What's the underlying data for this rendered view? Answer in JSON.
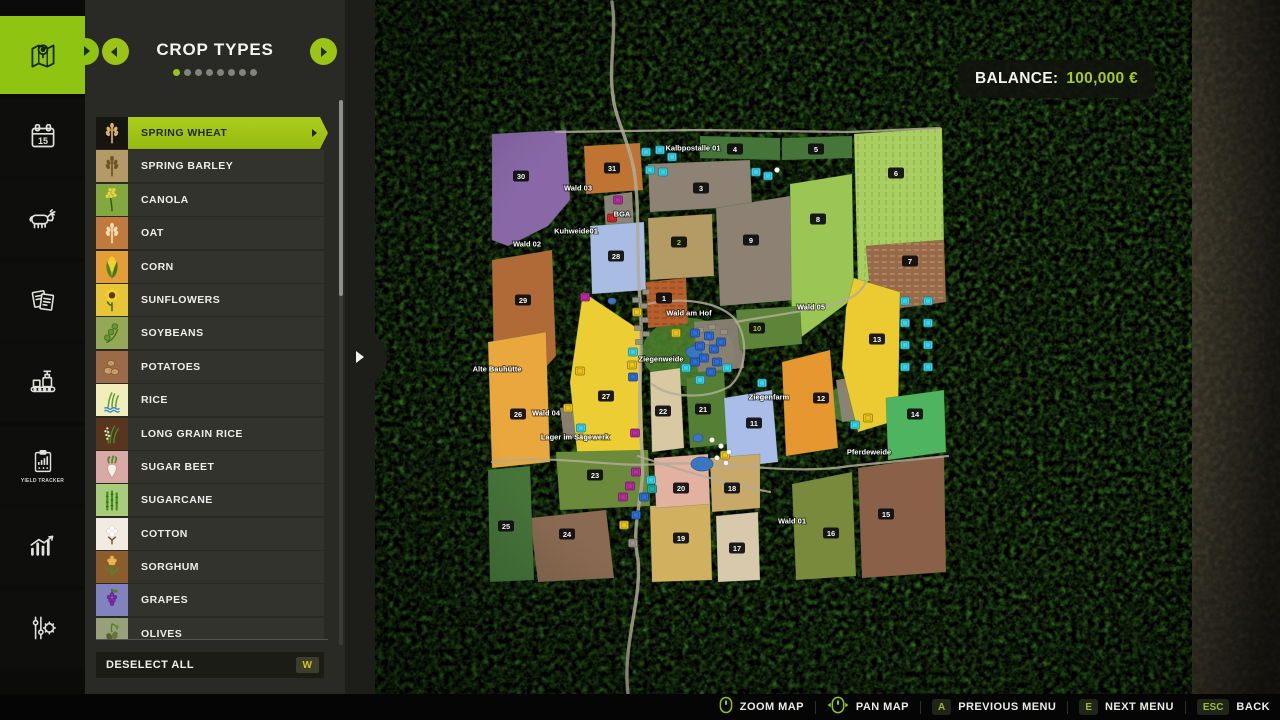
{
  "sidebar": {
    "items": [
      {
        "name": "map",
        "active": true
      },
      {
        "name": "calendar",
        "day": "15"
      },
      {
        "name": "animals"
      },
      {
        "name": "contracts"
      },
      {
        "name": "production"
      },
      {
        "name": "yield-tracker",
        "caption": "YIELD TRACKER"
      },
      {
        "name": "statistics"
      },
      {
        "name": "settings"
      }
    ]
  },
  "panel": {
    "title": "CROP TYPES",
    "dots": {
      "count": 8,
      "active_index": 0
    },
    "crops": [
      {
        "label": "SPRING WHEAT",
        "glyph": "wheat",
        "tile": "#17150f",
        "glyph_color": "#d9b26a",
        "selected": true
      },
      {
        "label": "SPRING BARLEY",
        "glyph": "barley",
        "tile": "#b39a67",
        "glyph_color": "#6e5426"
      },
      {
        "label": "CANOLA",
        "glyph": "canola",
        "tile": "#83a93e",
        "glyph_color": "#f2d23a"
      },
      {
        "label": "OAT",
        "glyph": "oat",
        "tile": "#bf7a3c",
        "glyph_color": "#f0dfae"
      },
      {
        "label": "CORN",
        "glyph": "corn",
        "tile": "#e59d35",
        "glyph_color": "#f2cf2e"
      },
      {
        "label": "SUNFLOWERS",
        "glyph": "sunflower",
        "tile": "#e6c636",
        "glyph_color": "#f5d02e"
      },
      {
        "label": "SOYBEANS",
        "glyph": "soybean",
        "tile": "#95a855",
        "glyph_color": "#659632"
      },
      {
        "label": "POTATOES",
        "glyph": "potato",
        "tile": "#9c6a46",
        "glyph_color": "#caa06c"
      },
      {
        "label": "RICE",
        "glyph": "rice",
        "tile": "#f2eebc",
        "glyph_color": "#5f9c3a"
      },
      {
        "label": "LONG GRAIN RICE",
        "glyph": "longrice",
        "tile": "#57361d",
        "glyph_color": "#efe6c8"
      },
      {
        "label": "SUGAR BEET",
        "glyph": "sugarbeet",
        "tile": "#d9a9a5",
        "glyph_color": "#f4efe4"
      },
      {
        "label": "SUGARCANE",
        "glyph": "sugarcane",
        "tile": "#a8cc7a",
        "glyph_color": "#3f8a22"
      },
      {
        "label": "COTTON",
        "glyph": "cotton",
        "tile": "#f2ebe2",
        "glyph_color": "#ffffff"
      },
      {
        "label": "SORGHUM",
        "glyph": "sorghum",
        "tile": "#8d5c2c",
        "glyph_color": "#e8b948"
      },
      {
        "label": "GRAPES",
        "glyph": "grapes",
        "tile": "#8183bf",
        "glyph_color": "#7e2aa8"
      },
      {
        "label": "OLIVES",
        "glyph": "olives",
        "tile": "#97a078",
        "glyph_color": "#55622c"
      }
    ],
    "deselect_all": {
      "label": "DESELECT ALL",
      "key": "W"
    }
  },
  "balance": {
    "label": "BALANCE:",
    "value": "100,000 €"
  },
  "footer": {
    "items": [
      {
        "icon": "mouse-wheel-icon",
        "label": "ZOOM MAP"
      },
      {
        "icon": "mouse-pan-icon",
        "label": "PAN MAP"
      },
      {
        "key": "A",
        "label": "PREVIOUS MENU"
      },
      {
        "key": "E",
        "label": "NEXT MENU"
      },
      {
        "key": "ESC",
        "label": "BACK"
      }
    ]
  },
  "map": {
    "field_numbers": [
      {
        "n": "1",
        "x": 664,
        "y": 298
      },
      {
        "n": "2",
        "x": 679,
        "y": 242,
        "green": true
      },
      {
        "n": "3",
        "x": 701,
        "y": 188
      },
      {
        "n": "4",
        "x": 735,
        "y": 149
      },
      {
        "n": "5",
        "x": 816,
        "y": 149
      },
      {
        "n": "6",
        "x": 896,
        "y": 173
      },
      {
        "n": "7",
        "x": 910,
        "y": 261
      },
      {
        "n": "8",
        "x": 818,
        "y": 219
      },
      {
        "n": "9",
        "x": 751,
        "y": 240
      },
      {
        "n": "10",
        "x": 757,
        "y": 328,
        "green": true
      },
      {
        "n": "11",
        "x": 754,
        "y": 423
      },
      {
        "n": "12",
        "x": 821,
        "y": 398
      },
      {
        "n": "13",
        "x": 877,
        "y": 339
      },
      {
        "n": "14",
        "x": 915,
        "y": 414
      },
      {
        "n": "15",
        "x": 886,
        "y": 514
      },
      {
        "n": "16",
        "x": 831,
        "y": 533
      },
      {
        "n": "17",
        "x": 737,
        "y": 548
      },
      {
        "n": "18",
        "x": 732,
        "y": 488
      },
      {
        "n": "19",
        "x": 681,
        "y": 538
      },
      {
        "n": "20",
        "x": 681,
        "y": 488
      },
      {
        "n": "21",
        "x": 703,
        "y": 409
      },
      {
        "n": "22",
        "x": 663,
        "y": 411
      },
      {
        "n": "23",
        "x": 595,
        "y": 475
      },
      {
        "n": "24",
        "x": 567,
        "y": 534
      },
      {
        "n": "25",
        "x": 506,
        "y": 526
      },
      {
        "n": "26",
        "x": 518,
        "y": 414
      },
      {
        "n": "27",
        "x": 606,
        "y": 396
      },
      {
        "n": "28",
        "x": 616,
        "y": 256
      },
      {
        "n": "29",
        "x": 523,
        "y": 300
      },
      {
        "n": "30",
        "x": 521,
        "y": 176
      },
      {
        "n": "31",
        "x": 612,
        "y": 168
      }
    ],
    "labels": [
      {
        "text": "Kalbpostalle 01",
        "x": 693,
        "y": 148
      },
      {
        "text": "Wald 03",
        "x": 578,
        "y": 188
      },
      {
        "text": "BGA",
        "x": 622,
        "y": 214
      },
      {
        "text": "Kuhweide01",
        "x": 576,
        "y": 231
      },
      {
        "text": "Wald 02",
        "x": 527,
        "y": 244
      },
      {
        "text": "Wald am Hof",
        "x": 689,
        "y": 313
      },
      {
        "text": "Wald 05",
        "x": 811,
        "y": 307
      },
      {
        "text": "Ziegenweide",
        "x": 661,
        "y": 359
      },
      {
        "text": "Alte Bauhütte",
        "x": 497,
        "y": 369
      },
      {
        "text": "Ziegenfarm",
        "x": 769,
        "y": 397
      },
      {
        "text": "Wald 04",
        "x": 546,
        "y": 413
      },
      {
        "text": "Lager im Sägewerk",
        "x": 575,
        "y": 437
      },
      {
        "text": "Pferdeweide",
        "x": 869,
        "y": 452
      },
      {
        "text": "Wald 01",
        "x": 792,
        "y": 521
      }
    ],
    "fields": [
      {
        "c": "#8a68a8",
        "pts": "492,134 566,130 570,200 548,226 508,246 492,240"
      },
      {
        "c": "#bf7434",
        "pts": "584,146 640,143 643,190 586,194"
      },
      {
        "c": "#8d8273",
        "pts": "648,164 750,160 752,206 650,212"
      },
      {
        "c": "#b49b63",
        "pts": "648,218 712,214 714,276 650,280"
      },
      {
        "c": "#8c8173",
        "pts": "716,208 790,196 794,300 720,306"
      },
      {
        "c": "#46753a",
        "pts": "700,136 780,138 780,160 700,158"
      },
      {
        "c": "#46753a",
        "pts": "782,138 852,136 852,158 782,160"
      },
      {
        "c": "#abce62",
        "pts": "854,134 942,128 944,248 858,286",
        "stripes": {
          "dir": "v",
          "color": "#84b140"
        }
      },
      {
        "c": "#9cc653",
        "pts": "790,184 852,174 854,298 792,344"
      },
      {
        "c": "#996a49",
        "pts": "866,246 944,240 946,302 872,312",
        "stripes": {
          "dir": "h",
          "color": "#c2a179"
        }
      },
      {
        "c": "#a9bde4",
        "pts": "590,226 644,222 646,290 592,294"
      },
      {
        "c": "#b06a38",
        "pts": "492,260 552,250 556,356 536,378 494,372"
      },
      {
        "c": "#b5602c",
        "pts": "646,282 686,278 688,324 648,328",
        "stripes": {
          "dir": "h",
          "color": "#8b3a1c"
        }
      },
      {
        "c": "#e9a73e",
        "pts": "488,342 546,332 550,462 492,468"
      },
      {
        "c": "#eccd33",
        "pts": "583,292 640,330 644,468 578,462 570,382"
      },
      {
        "c": "#d9c9a2",
        "pts": "650,372 680,368 684,448 652,452"
      },
      {
        "c": "#567f36",
        "pts": "686,378 724,372 728,444 690,448"
      },
      {
        "c": "#5d8438",
        "pts": "736,310 800,306 802,344 740,350"
      },
      {
        "c": "#a9bde8",
        "pts": "724,398 772,390 778,462 728,468"
      },
      {
        "c": "#e79730",
        "pts": "782,362 830,350 838,448 786,456"
      },
      {
        "c": "#ecca32",
        "pts": "854,278 900,292 898,420 858,432 842,368 846,308"
      },
      {
        "c": "#4fb45f",
        "pts": "886,398 944,390 946,452 888,460"
      },
      {
        "c": "#8a6049",
        "pts": "858,468 944,456 946,572 862,578"
      },
      {
        "c": "#7a8a3c",
        "pts": "792,484 852,472 856,576 796,580"
      },
      {
        "c": "#d9c9ac",
        "pts": "716,516 758,512 760,580 718,582"
      },
      {
        "c": "#c8a96a",
        "pts": "710,458 760,454 760,508 712,512"
      },
      {
        "c": "#d1b160",
        "pts": "650,506 710,502 712,580 652,582"
      },
      {
        "c": "#e2b1a0",
        "pts": "654,458 708,454 710,504 656,508"
      },
      {
        "c": "#6b8a3b",
        "pts": "556,452 648,450 650,506 560,510"
      },
      {
        "c": "#8a6a52",
        "pts": "530,518 606,510 614,578 538,582"
      },
      {
        "c": "#46753a",
        "pts": "488,470 530,466 534,580 490,582"
      }
    ],
    "meadows": [
      [
        688,
        352,
        46,
        34
      ],
      [
        850,
        404,
        26,
        18
      ]
    ],
    "patches": [
      {
        "c": "#8f897c",
        "pts": "604,196 632,192 634,230 606,234"
      },
      {
        "c": "#8b8274",
        "pts": "694,322 740,318 744,368 698,372"
      },
      {
        "c": "#8d8475",
        "pts": "836,380 872,374 878,416 842,422"
      },
      {
        "c": "#8d8475",
        "pts": "560,408 584,404 588,436 564,440"
      }
    ],
    "ponds": [
      [
        694,
        352,
        8,
        6
      ],
      [
        702,
        464,
        11,
        7
      ],
      [
        612,
        301,
        4,
        3
      ],
      [
        698,
        438,
        5,
        4
      ]
    ],
    "houses": [
      [
        636,
        300
      ],
      [
        644,
        306
      ],
      [
        637,
        314
      ],
      [
        645,
        320
      ],
      [
        638,
        328
      ],
      [
        646,
        334
      ],
      [
        639,
        342
      ],
      [
        646,
        292
      ],
      [
        700,
        330
      ],
      [
        712,
        327
      ],
      [
        724,
        332
      ],
      [
        706,
        342
      ],
      [
        718,
        346
      ]
    ],
    "poi_icons": {
      "cyan": [
        [
          646,
          152
        ],
        [
          660,
          150
        ],
        [
          672,
          157
        ],
        [
          650,
          170
        ],
        [
          663,
          172
        ],
        [
          756,
          172
        ],
        [
          768,
          176
        ],
        [
          633,
          352
        ],
        [
          686,
          368
        ],
        [
          700,
          380
        ],
        [
          727,
          368
        ],
        [
          762,
          383
        ],
        [
          651,
          480
        ],
        [
          855,
          425
        ],
        [
          581,
          428
        ],
        [
          905,
          301
        ],
        [
          928,
          301
        ],
        [
          905,
          323
        ],
        [
          928,
          323
        ],
        [
          905,
          345
        ],
        [
          928,
          345
        ],
        [
          905,
          367
        ],
        [
          928,
          367
        ]
      ],
      "blue": [
        [
          695,
          333
        ],
        [
          709,
          336
        ],
        [
          700,
          346
        ],
        [
          714,
          349
        ],
        [
          721,
          342
        ],
        [
          704,
          358
        ],
        [
          695,
          362
        ],
        [
          717,
          362
        ],
        [
          711,
          372
        ],
        [
          633,
          377
        ],
        [
          636,
          515
        ],
        [
          644,
          497
        ]
      ],
      "yellow": [
        [
          676,
          333
        ],
        [
          637,
          312
        ],
        [
          632,
          365
        ],
        [
          624,
          525
        ],
        [
          568,
          408
        ],
        [
          868,
          418
        ],
        [
          725,
          455
        ],
        [
          580,
          371
        ]
      ],
      "purple": [
        [
          618,
          200
        ],
        [
          585,
          297
        ],
        [
          635,
          433
        ],
        [
          636,
          472
        ],
        [
          630,
          486
        ],
        [
          623,
          497
        ]
      ],
      "red": [
        [
          612,
          218
        ]
      ],
      "white": [
        [
          712,
          440
        ],
        [
          721,
          446
        ],
        [
          729,
          452
        ],
        [
          717,
          458
        ],
        [
          726,
          463
        ],
        [
          777,
          170
        ]
      ],
      "teal": [
        [
          652,
          489
        ]
      ],
      "gray": [
        [
          633,
          543
        ]
      ]
    }
  }
}
